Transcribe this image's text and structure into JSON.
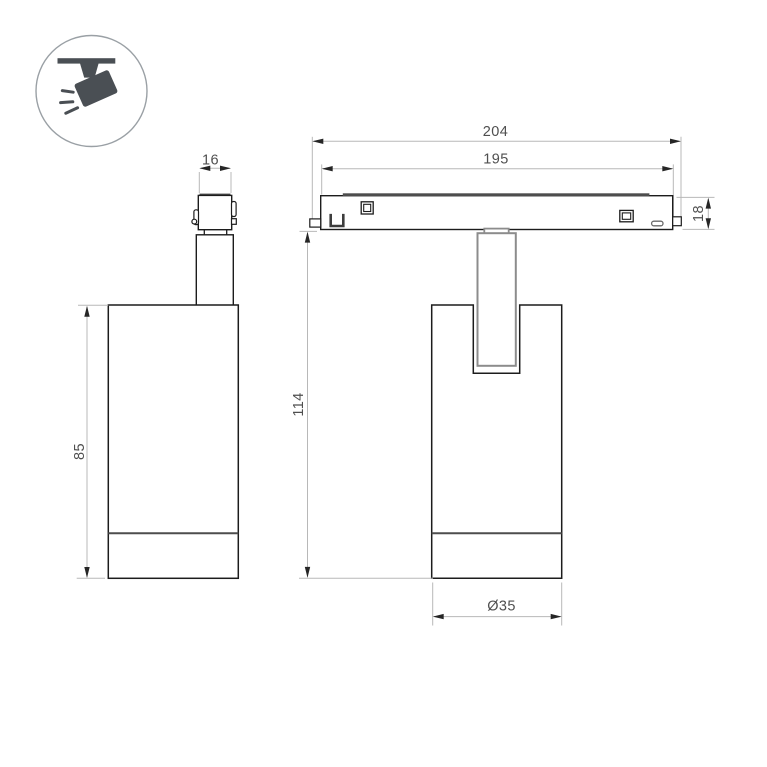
{
  "icon": {
    "name": "track-spotlight-icon",
    "glyph_color": "#4a4f54",
    "ring_color": "#9aa0a5"
  },
  "dims": {
    "d204": "204",
    "d195": "195",
    "d18": "18",
    "d114": "114",
    "d35": "Ø35",
    "d16": "16",
    "d85": "85"
  },
  "views": {
    "side_view": {
      "dimensions": [
        "16",
        "85"
      ]
    },
    "front_view": {
      "dimensions": [
        "204",
        "195",
        "18",
        "114",
        "Ø35"
      ]
    }
  },
  "colors": {
    "outline": "#1c1c1c",
    "secondary_line": "#4d4d4d",
    "stem_line": "#8c8c8c",
    "dim_line": "#b8b8b8",
    "dim_text": "#4f4f4f",
    "arrow": "#262626",
    "background": "#ffffff"
  }
}
